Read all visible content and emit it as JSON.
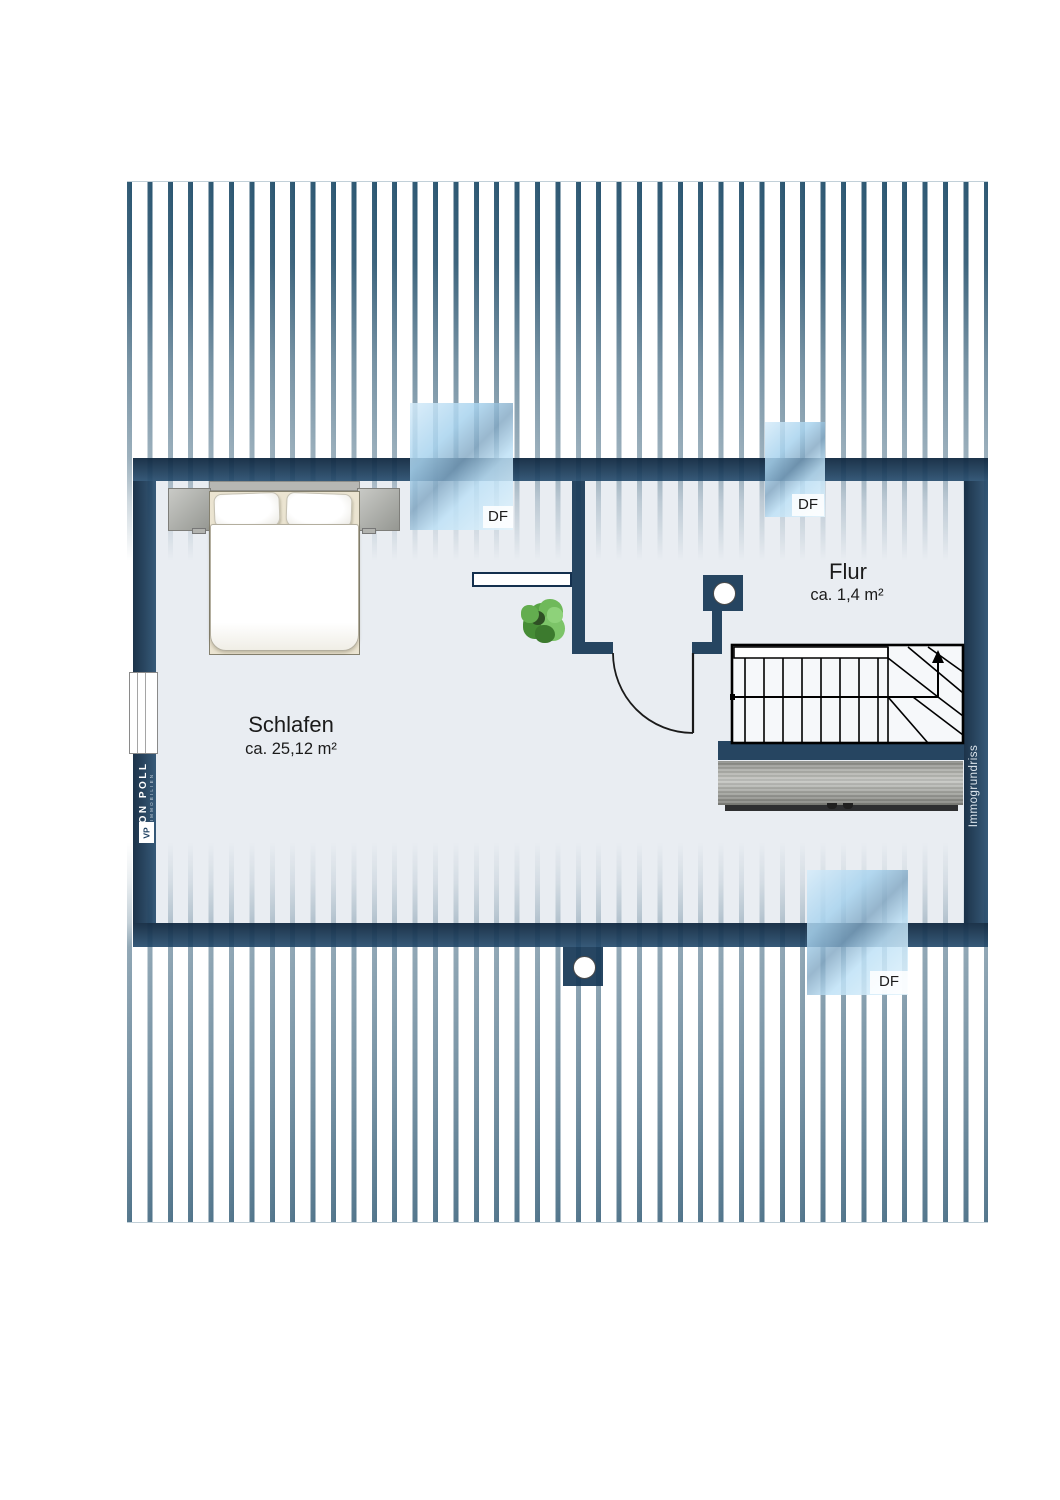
{
  "document": {
    "type_label": "attic floor plan"
  },
  "rooms": {
    "schlafen": {
      "name": "Schlafen",
      "area": "ca. 25,12 m²"
    },
    "flur": {
      "name": "Flur",
      "area": "ca. 1,4 m²"
    }
  },
  "skylights": {
    "s1": "DF",
    "s2": "DF",
    "s3": "DF"
  },
  "branding": {
    "logo_main": "VON POLL",
    "logo_sub": "IMMOBILIEN",
    "monogram": "VP",
    "watermark": "Immogrundriss"
  },
  "colors": {
    "wall_navy": "#17385a",
    "stripe_teal": "#1e4c69",
    "floor_gray": "#e9edf2",
    "glass_blue": "#a8d3ee",
    "plant_green": "#57a344",
    "wood_gray": "#9fa09b"
  }
}
